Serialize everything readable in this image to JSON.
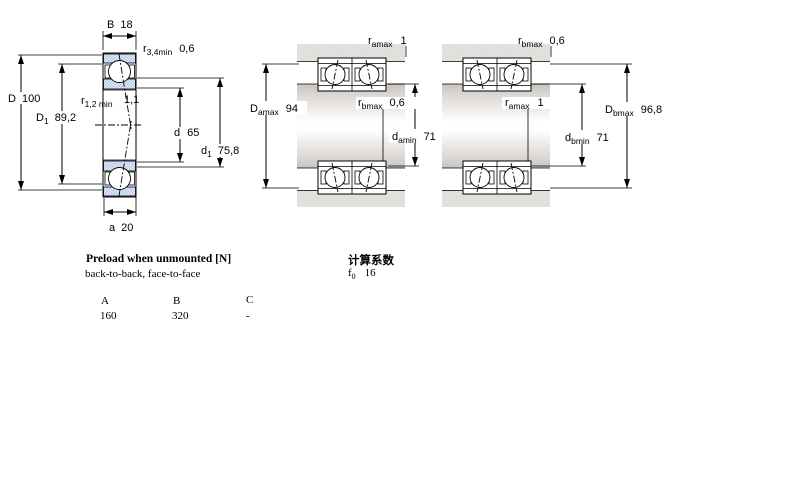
{
  "diagram": {
    "left": {
      "B": {
        "sym": "B",
        "val": "18"
      },
      "r34": {
        "sym": "r",
        "sub": "3,4min",
        "val": "0,6"
      },
      "D": {
        "sym": "D",
        "val": "100"
      },
      "D1": {
        "sym": "D",
        "sub": "1",
        "val": "89,2"
      },
      "r12": {
        "sym": "r",
        "sub": "1,2 min",
        "val": "1,1"
      },
      "d": {
        "sym": "d",
        "val": "65"
      },
      "d1": {
        "sym": "d",
        "sub": "1",
        "val": "75,8"
      },
      "a": {
        "sym": "a",
        "val": "20"
      }
    },
    "arr1": {
      "ramax": {
        "sym": "r",
        "sub": "amax",
        "val": "1"
      },
      "rbmax": {
        "sym": "r",
        "sub": "bmax",
        "val": "0,6"
      },
      "Damax": {
        "sym": "D",
        "sub": "amax",
        "val": "94"
      },
      "damin": {
        "sym": "d",
        "sub": "amin",
        "val": "71"
      }
    },
    "arr2": {
      "rbmax": {
        "sym": "r",
        "sub": "bmax",
        "val": "0,6"
      },
      "ramax": {
        "sym": "r",
        "sub": "amax",
        "val": "1"
      },
      "Dbmax": {
        "sym": "D",
        "sub": "bmax",
        "val": "96,8"
      },
      "dbmin": {
        "sym": "d",
        "sub": "bmin",
        "val": "71"
      }
    }
  },
  "preload": {
    "title": "Preload when unmounted [N]",
    "subtitle": "back-to-back, face-to-face",
    "columns": [
      "A",
      "B",
      "C"
    ],
    "values": [
      "160",
      "320",
      "-"
    ]
  },
  "calc": {
    "title": "计算系数",
    "f0": {
      "sym": "f",
      "sub": "0",
      "val": "16"
    }
  },
  "colors": {
    "housing_dither_dark": "#d9d5d1",
    "housing_dither_light": "#eceae7",
    "ring_blue_dark": "#b3c9e8",
    "ring_blue_light": "#e3ecf7",
    "shaft_edge": "#c8c4c0",
    "line": "#000000"
  }
}
